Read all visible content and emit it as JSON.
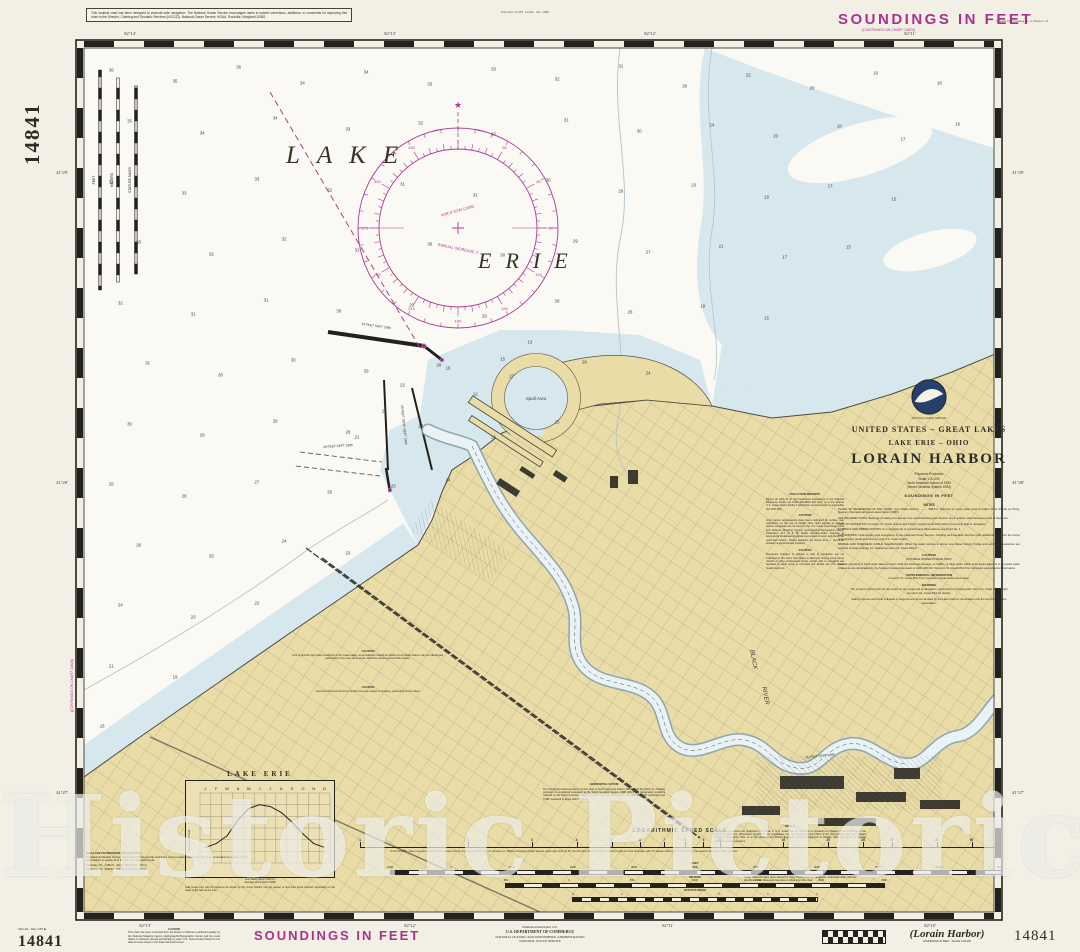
{
  "colors": {
    "magenta": "#a7338f",
    "land": "#e9dca6",
    "shallow": "#d6e7ee",
    "water": "#faf9f3",
    "paper": "#f2efe4",
    "ink": "#2e2c26"
  },
  "watermark": "Historic Pictoric ®",
  "margins": {
    "top_note": "This nautical chart has been designed to promote safe navigation. The National Ocean Service encourages users to submit corrections, additions, or comments for improving this chart to the Director, Charting and Geodetic Services (N/CG22), National Ocean Service, NOAA, Rockville, Maryland 20852.",
    "top_center_note": "Formerly LS 367, 1st Ed., Jan. 1960",
    "soundings_top": "SOUNDINGS IN FEET",
    "catalog_note": "Nautical Chart Catalog No. 4, Panels C, D",
    "chart_number_side": "14841",
    "continued_top": "(CONTINUED ON CHART 14820)",
    "continued_left": "(CONTINUED ON CHART 14826)"
  },
  "bottom": {
    "edition_note": "34th Ed., May 2/87 ■",
    "chart_number_left": "14841",
    "caution_header": "CAUTION",
    "caution_body": "This chart has been corrected from the Notice to Mariners published weekly by the Defense Mapping Agency Hydrographic/Topographic Center and the Local Notice to Mariners issued periodically by each U.S. Coast Guard District to the date of issue shown in the lower left hand corner.",
    "soundings_bottom": "SOUNDINGS IN FEET",
    "publisher_line1": "Published at Washington, D.C.",
    "publisher_line2": "U.S. DEPARTMENT OF COMMERCE",
    "publisher_line3": "NATIONAL OCEANIC AND ATMOSPHERIC ADMINISTRATION",
    "publisher_line4": "NATIONAL OCEAN SERVICE",
    "title_italic": "(Lorain Harbor)",
    "title_sub": "SOUNDINGS IN FEET - SCALE 1:20,000",
    "chart_number_right": "14841"
  },
  "border": {
    "top_labels": [
      {
        "text": "82°14'",
        "x": 130
      },
      {
        "text": "82°13'",
        "x": 390
      },
      {
        "text": "82°12'",
        "x": 650
      },
      {
        "text": "82°11'",
        "x": 910
      }
    ],
    "bottom_labels": [
      {
        "text": "82°13'",
        "x": 145
      },
      {
        "text": "82°12'",
        "x": 410
      },
      {
        "text": "82°11'",
        "x": 668
      },
      {
        "text": "82°10'",
        "x": 930
      }
    ],
    "left_labels": [
      {
        "text": "41°29'",
        "y": 170
      },
      {
        "text": "41°28'",
        "y": 480
      },
      {
        "text": "41°27'",
        "y": 790
      }
    ],
    "right_labels": [
      {
        "text": "41°29'",
        "y": 170
      },
      {
        "text": "41°28'",
        "y": 480
      },
      {
        "text": "41°27'",
        "y": 790
      }
    ]
  },
  "map": {
    "lake_word1": "LAKE",
    "lake_word2": "ERIE",
    "river_word1": "BLACK",
    "river_word2": "RIVER",
    "spoil_label": "Spoil Area",
    "channel_label_1": "26 FEET SEPT 1986",
    "channel_label_2": "28 FEET JUNE–SEPT 1986",
    "channel_label_3": "28 FEET SEPT 1986",
    "channel_label_4": "25 FEET SEPT 1986",
    "vertical_scale_feet": "FEET",
    "vertical_scale_meters": "METERS",
    "vertical_scale_miles": "STATUTE MILES",
    "compass_var1": "VAR 6°15'W (1985)",
    "compass_var2": "ANNUAL INCREASE 2'",
    "soundings": [
      [
        3,
        2.5,
        36
      ],
      [
        10,
        3.8,
        35
      ],
      [
        17,
        2.2,
        36
      ],
      [
        24,
        4,
        34
      ],
      [
        31,
        2.8,
        34
      ],
      [
        38,
        4.2,
        33
      ],
      [
        45,
        2.4,
        33
      ],
      [
        52,
        3.6,
        32
      ],
      [
        59,
        2.1,
        31
      ],
      [
        66,
        4.4,
        28
      ],
      [
        73,
        3.1,
        22
      ],
      [
        80,
        4.6,
        20
      ],
      [
        87,
        2.9,
        19
      ],
      [
        94,
        4.1,
        18
      ],
      [
        5,
        8.5,
        35
      ],
      [
        13,
        9.8,
        34
      ],
      [
        21,
        8.1,
        34
      ],
      [
        29,
        9.4,
        33
      ],
      [
        37,
        8.7,
        32
      ],
      [
        45,
        10,
        32
      ],
      [
        53,
        8.3,
        31
      ],
      [
        61,
        9.6,
        30
      ],
      [
        69,
        8.9,
        24
      ],
      [
        76,
        10.2,
        20
      ],
      [
        83,
        9,
        18
      ],
      [
        90,
        10.5,
        17
      ],
      [
        96,
        8.8,
        16
      ],
      [
        3,
        15.5,
        34
      ],
      [
        11,
        16.8,
        33
      ],
      [
        19,
        15.2,
        33
      ],
      [
        27,
        16.4,
        32
      ],
      [
        35,
        15.7,
        31
      ],
      [
        43,
        17,
        31
      ],
      [
        51,
        15.3,
        30
      ],
      [
        59,
        16.6,
        29
      ],
      [
        67,
        15.9,
        23
      ],
      [
        75,
        17.2,
        19
      ],
      [
        82,
        16,
        17
      ],
      [
        89,
        17.5,
        15
      ],
      [
        6,
        22.5,
        33
      ],
      [
        14,
        23.8,
        32
      ],
      [
        22,
        22.1,
        32
      ],
      [
        30,
        23.4,
        31
      ],
      [
        38,
        22.7,
        30
      ],
      [
        46,
        24,
        30
      ],
      [
        54,
        22.3,
        29
      ],
      [
        62,
        23.6,
        27
      ],
      [
        70,
        22.9,
        21
      ],
      [
        77,
        24.2,
        17
      ],
      [
        84,
        23,
        15
      ],
      [
        4,
        29.5,
        32
      ],
      [
        12,
        30.8,
        31
      ],
      [
        20,
        29.2,
        31
      ],
      [
        28,
        30.4,
        30
      ],
      [
        36,
        29.7,
        29
      ],
      [
        44,
        31,
        29
      ],
      [
        52,
        29.3,
        28
      ],
      [
        60,
        30.6,
        26
      ],
      [
        68,
        29.9,
        19
      ],
      [
        75,
        31.2,
        15
      ],
      [
        7,
        36.5,
        31
      ],
      [
        15,
        37.8,
        30
      ],
      [
        23,
        36.1,
        30
      ],
      [
        31,
        37.4,
        29
      ],
      [
        39,
        36.7,
        28
      ],
      [
        47,
        38,
        27
      ],
      [
        55,
        36.3,
        26
      ],
      [
        62,
        37.6,
        24
      ],
      [
        5,
        43.5,
        30
      ],
      [
        13,
        44.8,
        29
      ],
      [
        21,
        43.2,
        29
      ],
      [
        29,
        44.4,
        28
      ],
      [
        37,
        43.7,
        27
      ],
      [
        45,
        45,
        26
      ],
      [
        52,
        43.3,
        25
      ],
      [
        3,
        50.5,
        28
      ],
      [
        11,
        51.8,
        28
      ],
      [
        19,
        50.2,
        27
      ],
      [
        27,
        51.4,
        26
      ],
      [
        34,
        50.7,
        25
      ],
      [
        40,
        50,
        24
      ],
      [
        6,
        57.5,
        26
      ],
      [
        14,
        58.8,
        25
      ],
      [
        22,
        57.1,
        24
      ],
      [
        29,
        58.4,
        23
      ],
      [
        4,
        64.5,
        24
      ],
      [
        12,
        65.8,
        23
      ],
      [
        19,
        64.2,
        22
      ],
      [
        3,
        71.5,
        21
      ],
      [
        10,
        72.8,
        19
      ],
      [
        2,
        78.5,
        16
      ],
      [
        30,
        45,
        21
      ],
      [
        33,
        42,
        24
      ],
      [
        35,
        39,
        22
      ],
      [
        40,
        37,
        18
      ],
      [
        43,
        40,
        12
      ],
      [
        46,
        36,
        15
      ],
      [
        49,
        34,
        13
      ]
    ]
  },
  "title_block": {
    "agency_small": "NATIONAL OCEAN SERVICE",
    "line1": "UNITED STATES – GREAT LAKES",
    "line2": "LAKE ERIE – OHIO",
    "title": "LORAIN HARBOR",
    "proj1": "Polyconic Projection",
    "proj2": "Scale 1:20,000",
    "proj3": "North American Datum of 1983",
    "proj4": "(World Geodetic System 1984)",
    "soundings": "SOUNDINGS IN FEET",
    "notes_header": "NOTES",
    "plane": "PLANE OF REFERENCE OF THE CHART (Low Water Datum) .......... 568.6 ft. Referred to mean water level at Father Point (Pointe au Père), Quebec, International Great Lakes Datum (1955).",
    "sailing": "SAILING DIRECTIONS: Bearings of sailing courses are true and distances given thereon are in statute miles between points of departure.",
    "aids": "AIDS TO NAVIGATION: Consult U.S. Coast Guard Light List for supplemental information concerning aids to navigation.",
    "symbols": "SYMBOLS AND ABBREVIATIONS: For complete list of symbols and abbreviations see Chart No. 1.",
    "authorities": "AUTHORITIES: Hydrography and topography by the National Ocean Service, Charting and Geodetic Services with additional data from the Corps of Engineers, Geological Survey, and U.S. Coast Guard.",
    "bridge": "BRIDGE AND OVERHEAD CABLE CLEARANCES: When the water surface is above Low Water Datum, bridge and overhead clearances are reduced correspondingly. For clearances see U.S. Coast Pilot 6.",
    "caution_header": "CAUTION",
    "pwi_header": "POTABLE WATER INTAKE (PWI)",
    "pwi_body": "Vessels operating in fresh water lakes or rivers shall not discharge sewage, or ballast, or bilge water within such areas adjacent to domestic water intakes as are designated by the Surgeon General pursuant to CFR 1250.93. Consult U.S. Coast Pilot 6 for important supplemental information.",
    "supp_header": "SUPPLEMENTAL INFORMATION",
    "supp_body": "Consult U.S. Coast Pilot 6 for important supplemental information.",
    "warning_header": "WARNING",
    "warning_body": "The prudent mariner will not rely solely on any single aid to navigation, particularly on floating aids. See U.S. Coast Guard Light List and U.S. Coast Pilot for details.",
    "magenta_note": "Sailing courses and limits indicated in magenta are recommended by the Lake Carriers' Association and the Dominion Marine Association."
  },
  "notes_column": {
    "pollution_header": "POLLUTION REPORTS",
    "pollution_body": "Report all spills of oil and hazardous substances to the National Response Center via 1-800-424-8802 (toll free), or to the nearest U.S. Coast Guard facility if telephone communication is impossible (33 CFR 153).",
    "caution1_header": "CAUTION",
    "caution1_body": "Only marine radiobeacons have been calibrated for surface use. Limitations on the use of certain other radio signals as aids to marine navigation can be found in the U.S. Coast Guard Light Lists and Defense Mapping Agency Hydrographic/Topographic Center Publication 117 (A & B). Radio direction-finder bearings to commercial broadcasting stations are subject to error and should be used with caution. Station positions are shown thus: ○ (Accurate location)  ● (Approximate location)",
    "caution2_header": "CAUTION",
    "caution2_body": "Temporary changes or defects in aids to navigation are not indicated on this chart. See Notice to Mariners. During some winter months or when endangered by ice, certain aids to navigation are replaced by other types or removed. For details see U.S. Coast Guard Light List."
  },
  "land_notes": {
    "caution1_header": "CAUTION",
    "caution1_body": "Due to periodic high water conditions in the Great Lakes, some features charted as visible at Low Water Datum may be submerged, particularly in the near shore areas. Mariners should proceed with caution.",
    "caution2_header": "CAUTION",
    "caution2_body": "Improved channels shown by broken lines are subject to shoaling, particularly at the edges.",
    "note_a_header": "NOTE A",
    "note_a_body": "Navigation regulations are published in Chapter 2, U.S. Coast Pilot 6. Additions or revisions to Chapter 2 are published in the Notices to Mariners. Information concerning the regulations may be obtained at the Office of the Commander, 9th Coast Guard District in Cleveland, Ohio, or at the Office of the District Engineer, Corps of Engineers in Buffalo, New York. Refer to charted regulation section numbers.",
    "radar_header": "RADAR REFLECTORS",
    "radar_body": "Radar reflectors have been placed on many floating aids to navigation. Individual radar reflector identification on these aids has been omitted from this chart.",
    "datum_header": "HORIZONTAL DATUM",
    "datum_body": "The horizontal reference datum of this chart is North American Datum 1983 (NAD 83) which for charting purposes is considered equivalent to the World Geodetic System 1984 (WGS 84). Geographic positions referred to the North American Datum of 1927 must be corrected an average of 0.159' northward and 0.452' eastward to agree with this chart."
  },
  "insets": {
    "gauge": {
      "title": "LAKE ERIE",
      "ylabel": "Elevation in feet",
      "months": [
        "J",
        "F",
        "M",
        "A",
        "M",
        "J",
        "J",
        "A",
        "S",
        "O",
        "N",
        "D"
      ],
      "values": [
        570.8,
        570.9,
        571.1,
        571.5,
        571.8,
        571.9,
        571.85,
        571.7,
        571.45,
        571.15,
        570.9,
        570.8
      ],
      "note1": "Low Water Datum 568.6 ft",
      "note2": "Average curve (IGLD 1955)",
      "caption": "Lake levels vary with the seasons as shown by the curve. Depths may be greater or less than those charted, depending on the stage of the lake at the time."
    },
    "speed_scale": {
      "title": "LOGARITHMIC SPEED SCALE",
      "ticks": [
        1,
        2,
        3,
        4,
        5,
        6,
        7,
        8,
        9,
        10,
        15,
        20,
        25,
        30,
        40,
        50,
        60
      ],
      "note": "To find SPEED, place one point of dividers on distance run (in any unit) and the other on minutes run. Without changing divider spread, place right point on 60; the left point will then indicate speed in units per hour. Example: with 4.0 statute miles run in 11.5 minutes, the speed is 21 statute miles per hour."
    },
    "bars": {
      "feet": {
        "label": "FEET",
        "ticks": [
          "1000",
          "0",
          "1000",
          "2000",
          "3000",
          "4000",
          "5000",
          "6000",
          "7000",
          "8000",
          "9000"
        ]
      },
      "meters": {
        "label": "METERS",
        "ticks": [
          "500",
          "0",
          "500",
          "1000",
          "1500",
          "2000",
          "2500"
        ]
      },
      "miles": {
        "label": "STATUTE MILES",
        "ticks": [
          "¼",
          "0",
          "¼",
          "½",
          "¾",
          "1"
        ]
      }
    },
    "weather": {
      "header": "NOAA VHF-FM WEATHER BROADCASTS",
      "body": "The National Weather Service stations listed below provide continuous marine weather broadcasts. The range of reception is variable, but for most stations is usually 20 to 40 miles from the antenna site.",
      "station1": "Sandusky, Oh.   KHB-97   162.40 MHz (Chan. WX-2)",
      "station2": "Cleveland, Oh.  KHB-59   162.55 MHz (Chan. WX-1)"
    }
  }
}
